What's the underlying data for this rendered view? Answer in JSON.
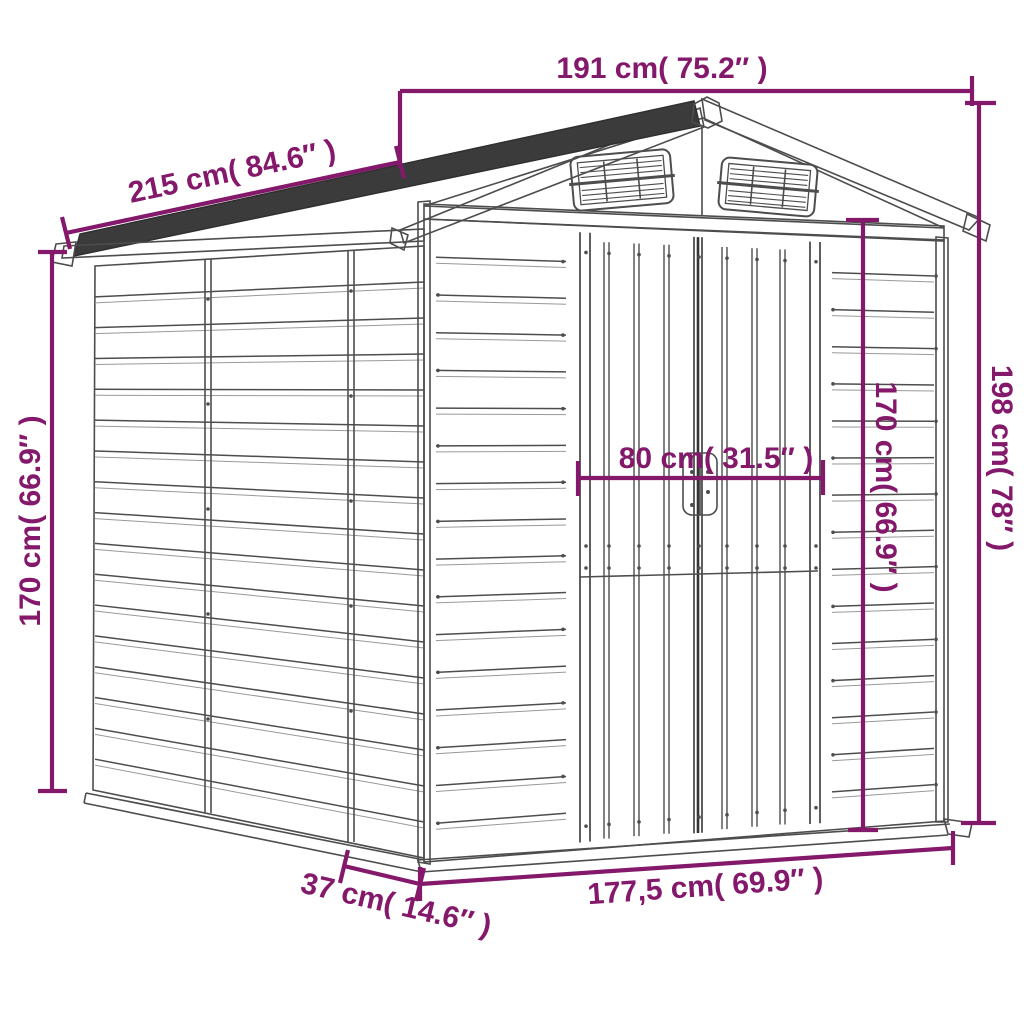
{
  "drawing": {
    "subject_label": "",
    "colors": {
      "dimension_accent": "#84186B",
      "line_art": "#4D4D4D",
      "roof_dark": "#3B3B3B",
      "background": "#FFFFFF"
    }
  },
  "dimensions": {
    "roof_width": {
      "label": "191 cm( 75.2″ )"
    },
    "roof_depth": {
      "label": "215 cm( 84.6″ )"
    },
    "wall_height_left": {
      "label": "170 cm( 66.9″ )"
    },
    "total_height": {
      "label": "198 cm( 78″ )"
    },
    "door_height": {
      "label": "170 cm( 66.9″ )"
    },
    "door_width": {
      "label": "80 cm( 31.5″ )"
    },
    "base_width": {
      "label": "177,5 cm( 69.9″ )"
    },
    "base_depth": {
      "label": "37 cm( 14.6″ )"
    }
  }
}
